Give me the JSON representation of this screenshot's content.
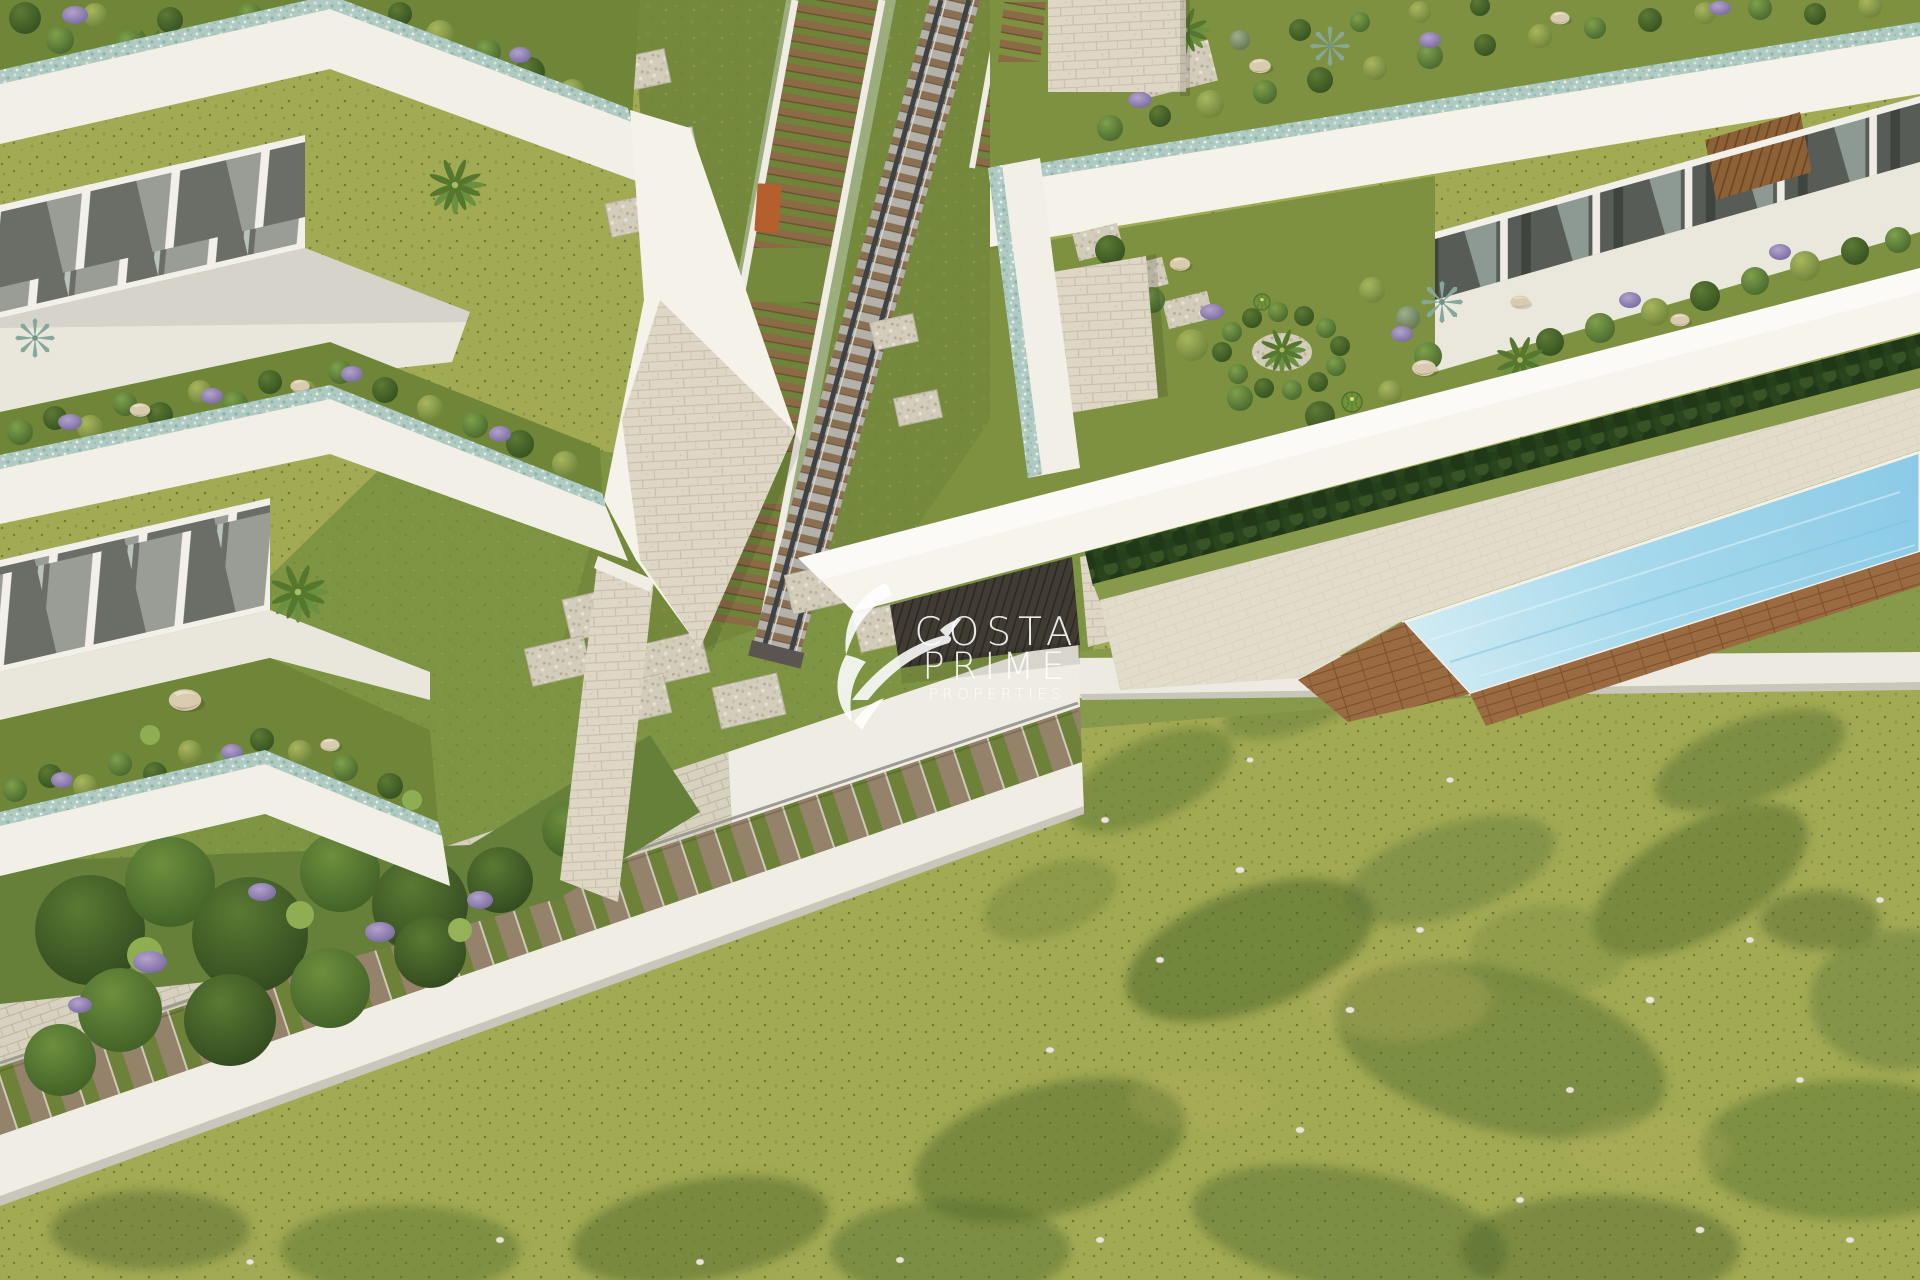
{
  "image": {
    "kind": "aerial 3D architectural render",
    "subject": "modern white apartment complex with rooftop gardens, central stairway with rail lift, lap pool, stepped walkway and large lawn"
  },
  "watermark": {
    "line1": "COSTA",
    "line2": "PRIME",
    "line3": "PROPERTIES",
    "logo_icon": "hummingbird-logo",
    "color": "#ffffff"
  },
  "palette": {
    "wall_white": "#f2efe7",
    "wall_shade": "#ddd9cf",
    "glass_dark": "#6a6e67",
    "glass_light": "#999d96",
    "teal_pebble": "#aecac2",
    "grass_garden": "#6f8638",
    "grass_courtyard": "#7d9443",
    "lawn": "#a3aa54",
    "lawn_patch": "#4f682e",
    "stone": "#ded7c5",
    "gravel": "#d2ccba",
    "wood_tread": "#8a6b46",
    "deck_wood": "#9a6a41",
    "rail_steel": "#3d4246",
    "pool_light": "#cfeaf2",
    "pool_deep": "#8ccbe6",
    "hedge": "#2a451d",
    "lavender": "#9d8ab8",
    "travertine": "#e8e2d2",
    "watermark_color": "#ffffff"
  }
}
